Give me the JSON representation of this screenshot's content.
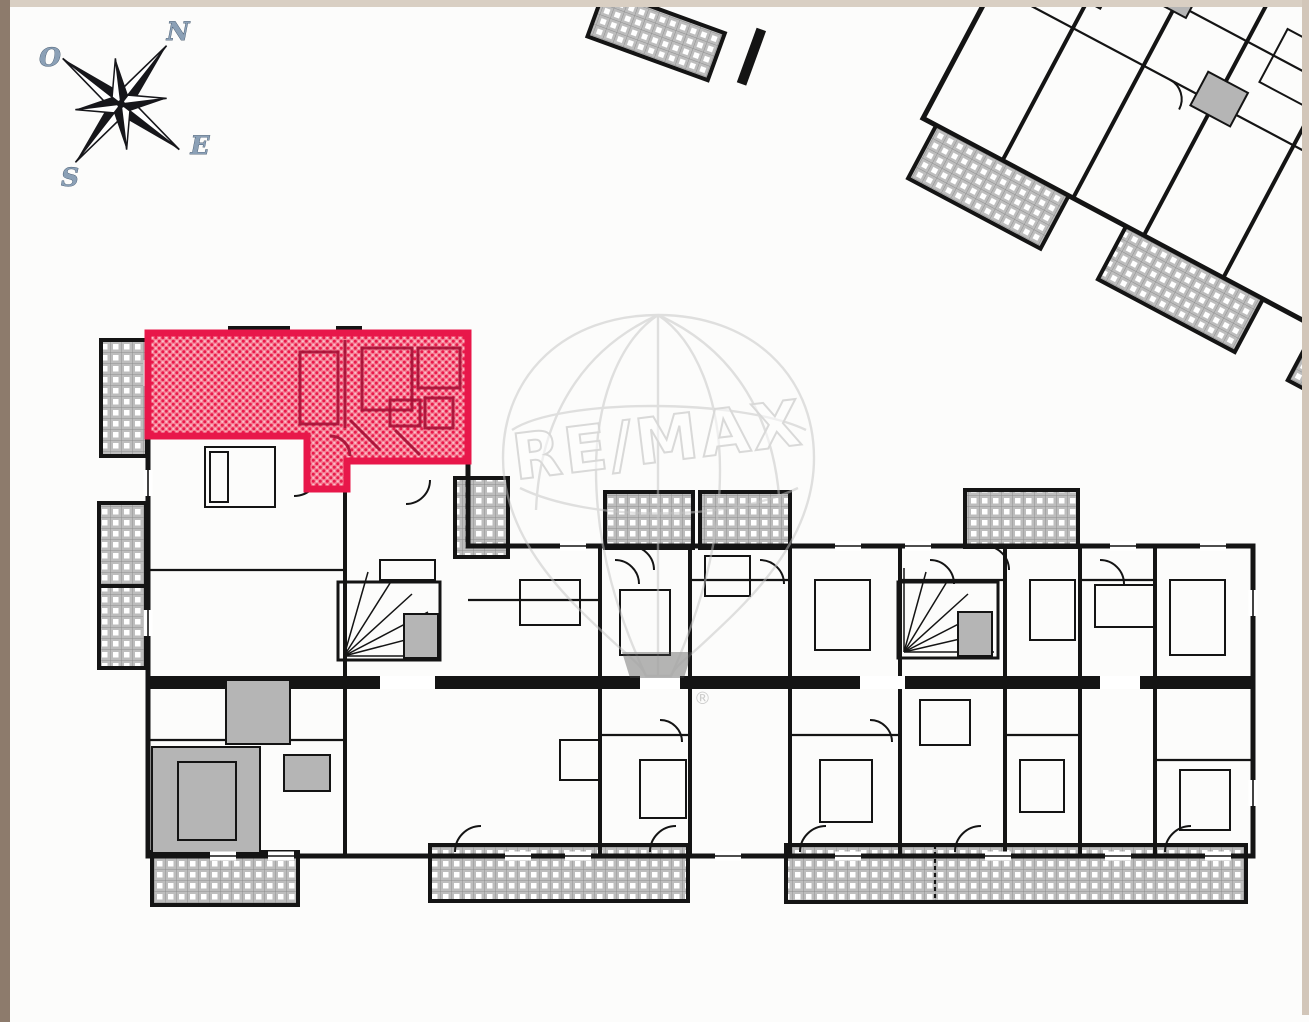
{
  "page": {
    "background": "#fcfcfb"
  },
  "frame": {
    "left_color": "#8d7b6c",
    "top_color": "#d9cfc3",
    "right_color": "#d2c6b9"
  },
  "compass": {
    "label_north": "N",
    "label_west": "O",
    "label_south": "S",
    "label_east": "E",
    "rotation_deg": 38,
    "needle_color": "#16161a",
    "label_color": "#8ba0b6",
    "label_outline": "#32465c"
  },
  "watermark": {
    "brand": "RE/MAX",
    "registered_mark": "®",
    "symbol": "hot-air-balloon",
    "line_color": "#c3c3c3"
  },
  "highlight": {
    "border_color": "#e8174a",
    "fill_base": "#f68196",
    "dot_color": "#e81a4b"
  },
  "plan": {
    "wall_color": "#141414",
    "room_fill": "#ffffff",
    "gray_fill": "#b5b5b5",
    "balcony_base": "#bdbdbd",
    "balcony_square": "#ffffff"
  }
}
